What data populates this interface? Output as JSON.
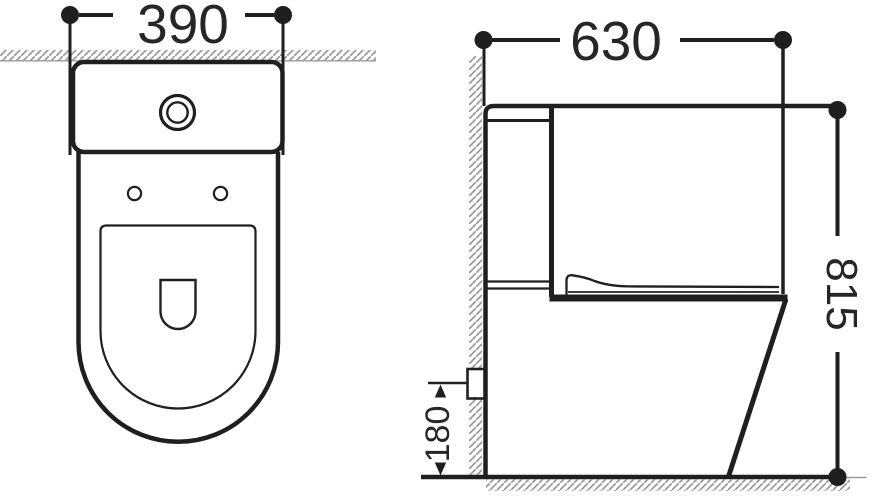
{
  "drawing": {
    "type": "technical dimension drawing",
    "subject": "two-piece toilet, top view and side view",
    "views": [
      {
        "name": "top view"
      },
      {
        "name": "side view"
      }
    ],
    "colors": {
      "background": "#ffffff",
      "line": "#1f1f1f",
      "text": "#262626",
      "hatch": "#9b9b9b"
    }
  },
  "dims": {
    "d390": "390",
    "d630": "630",
    "d815": "815",
    "d180": "180"
  }
}
